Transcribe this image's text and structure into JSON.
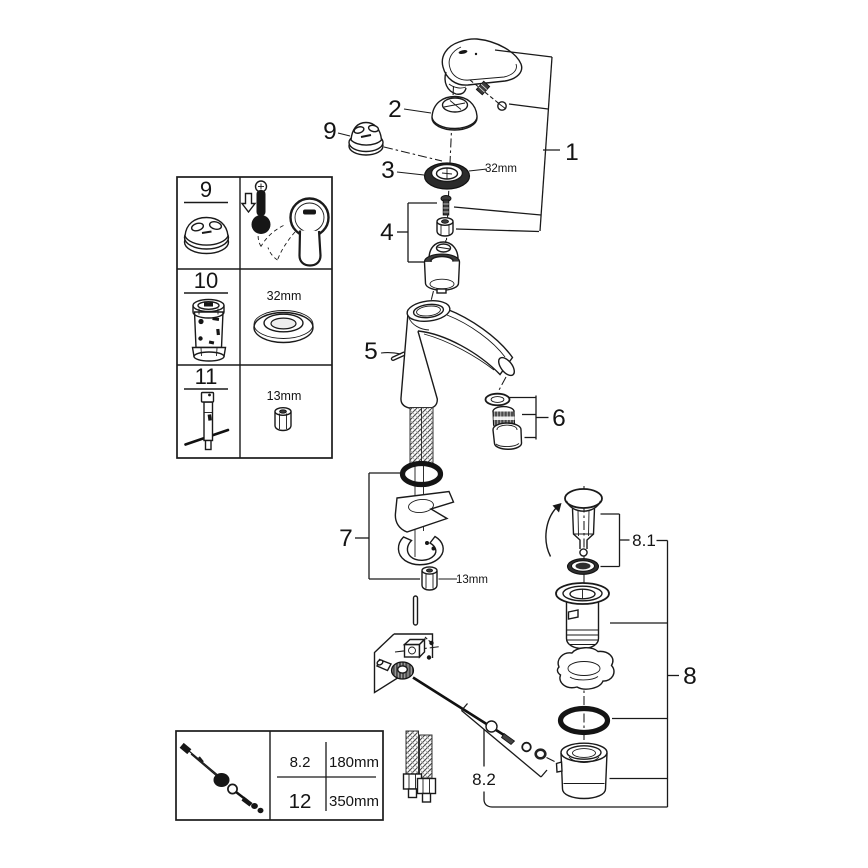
{
  "colors": {
    "ink": "#1a1a1a",
    "background": "#ffffff"
  },
  "callouts": {
    "one": "1",
    "two": "2",
    "three": "3",
    "four": "4",
    "five": "5",
    "six": "6",
    "seven": "7",
    "eight": "8",
    "eight_one": "8.1",
    "eight_two": "8.2",
    "nine": "9"
  },
  "dims": {
    "ring_32": "32mm",
    "nut_13": "13mm"
  },
  "parts_box": {
    "row9_num": "9",
    "row10_num": "10",
    "row10_dim": "32mm",
    "row11_num": "11",
    "row11_dim": "13mm"
  },
  "size_table": {
    "row1_ref": "8.2",
    "row1_len": "180mm",
    "row2_ref": "12",
    "row2_len": "350mm"
  }
}
